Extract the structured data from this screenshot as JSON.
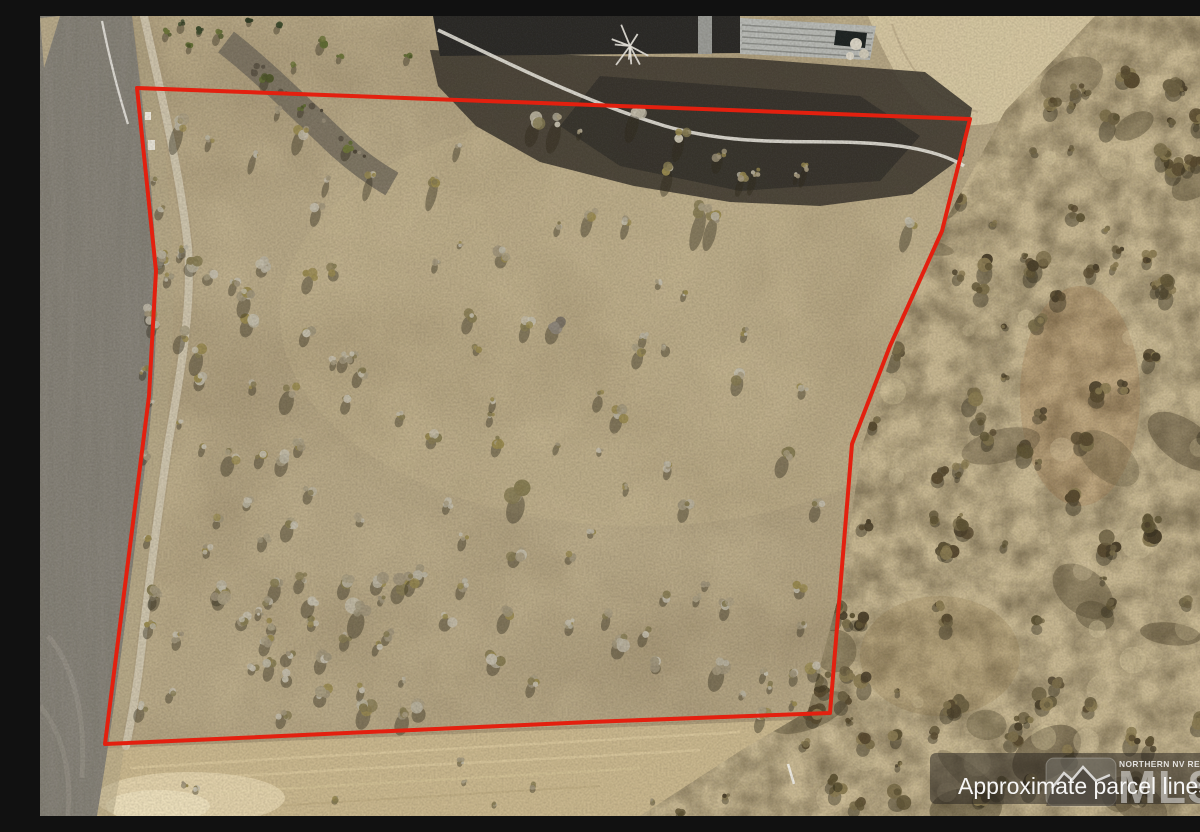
{
  "meta": {
    "type": "aerial-drone-photo",
    "subject": "Vacant desert land parcel with red approximate boundary overlay, paved road at left, home at top, brushy hillside at right"
  },
  "overlay": {
    "parcel_line_label": "Approximate parcel lines",
    "mls_region": "NORTHERN NV REGIONAL",
    "mls_abbrev": "MLS"
  },
  "parcel": {
    "outline_points": "97,72 930,103 902,215 850,330 812,428 800,575 790,697 550,706 65,728 109,380 116,255",
    "outline_color": "#e3200f",
    "outline_width": "4"
  },
  "palette": {
    "dirt": "#b6a786",
    "dirt_dark": "#7d6c50",
    "dirt_light": "#dbcba4",
    "road": "#87837a",
    "road_streak": "#6e6a61",
    "shoulder": "#b2a586",
    "trail": "#cfc6b0",
    "graded": "#c9b78e",
    "graded_light": "#e4d5af",
    "hillside": "#c6b691",
    "hillside_dark": "#463b26",
    "shadow": "#2e2819",
    "house_shadow": "#3f3a31",
    "roof_dark": "#2a2927",
    "roof_metal": "#b7b9b5",
    "walkway": "#efece4",
    "watermark_bar": "rgba(38,35,30,0.52)"
  }
}
